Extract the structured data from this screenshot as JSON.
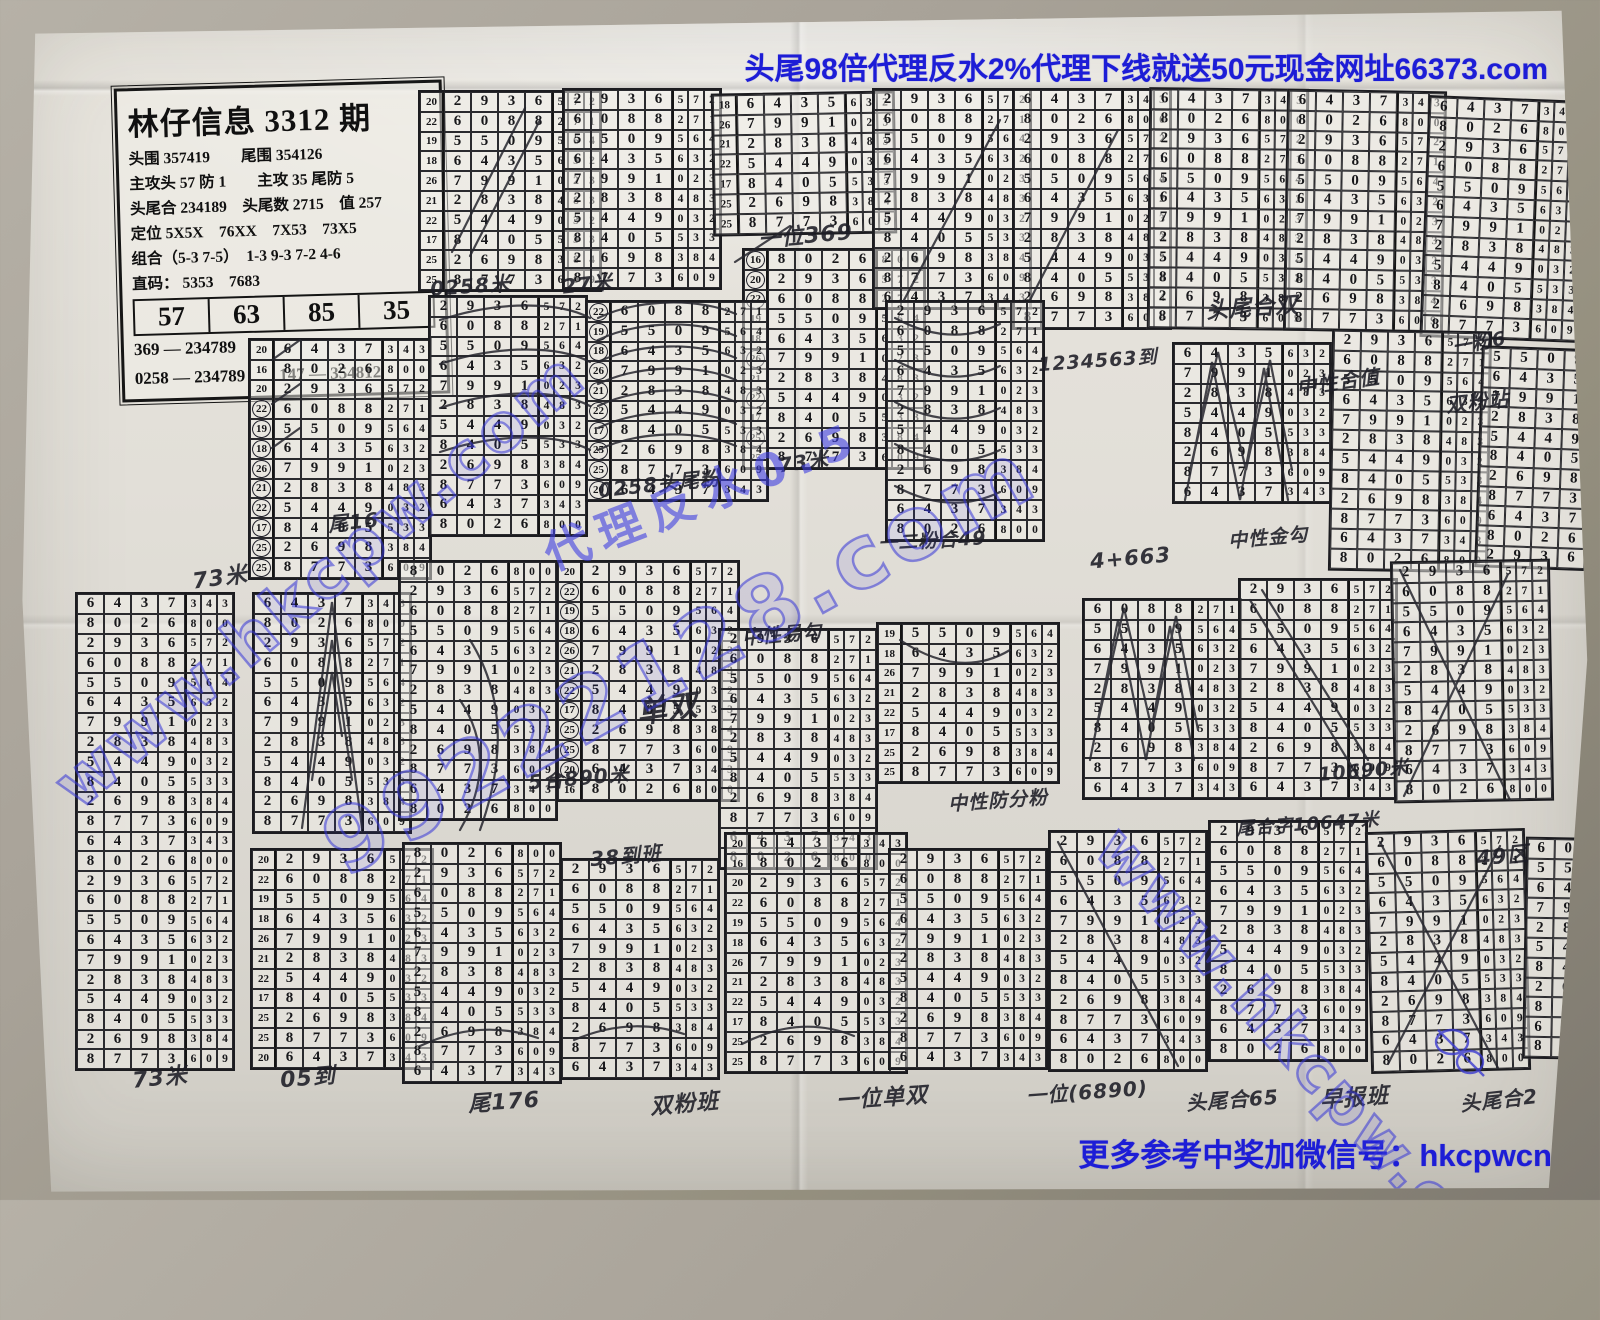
{
  "banners": {
    "top": "头尾98倍代理反水2%代理下线就送50元现金网址66373.com",
    "bottom": "更多参考中奖加微信号：hkcpwcn"
  },
  "info_box": {
    "title": "林仔信息 3312 期",
    "lines": [
      "头围 357419　　尾围 354126",
      "主攻头 57 防 1　　主攻 35 尾防 5",
      "头尾合 234189　头尾数 2715　值 257",
      "定位 5X5X　76XX　7X53　73X5",
      "组合（5-3 7-5）　1-3 9-3 7-2 4-6",
      "直码：  5353　7683"
    ],
    "big_numbers": [
      "57",
      "63",
      "85",
      "35"
    ],
    "footer_lines": [
      "369 — 234789",
      "0258 — 234789　　147 — 354812"
    ]
  },
  "watermarks": {
    "left": "www.hkcpw.com",
    "center": "99222128.com",
    "right": "www.hkcpw.com",
    "diagonal": "代理反水0.5"
  },
  "grid_base": {
    "row_labels": [
      "20",
      "16",
      "20",
      "22",
      "19",
      "18",
      "26",
      "21",
      "22",
      "17",
      "25",
      "25"
    ],
    "rows": [
      "6437343",
      "8026800",
      "2936572",
      "6088271",
      "5509564",
      "6435632",
      "7991023",
      "2838483",
      "5449032",
      "8405533",
      "2698384",
      "8773609"
    ]
  },
  "grids": [
    {
      "x": 418,
      "y": 90,
      "start": 2,
      "count": 10,
      "labels": true,
      "rot": 0
    },
    {
      "x": 562,
      "y": 88,
      "start": 2,
      "count": 10,
      "labels": false,
      "rot": 0
    },
    {
      "x": 712,
      "y": 92,
      "start": 5,
      "count": 7,
      "labels": true,
      "rot": -1
    },
    {
      "x": 742,
      "y": 248,
      "start": 1,
      "count": 11,
      "labels": true,
      "rot": 0,
      "circled": [
        0,
        1,
        2,
        5,
        7,
        9
      ]
    },
    {
      "x": 872,
      "y": 88,
      "start": 2,
      "count": 11,
      "labels": false,
      "rot": 0
    },
    {
      "x": 1012,
      "y": 88,
      "start": 0,
      "count": 12,
      "labels": false,
      "rot": 0
    },
    {
      "x": 1148,
      "y": 88,
      "start": 0,
      "count": 12,
      "labels": false,
      "rot": 0.6
    },
    {
      "x": 1285,
      "y": 90,
      "start": 0,
      "count": 12,
      "labels": false,
      "rot": 1
    },
    {
      "x": 1424,
      "y": 98,
      "start": 0,
      "count": 12,
      "labels": false,
      "rot": 2.2
    },
    {
      "x": 248,
      "y": 338,
      "start": 0,
      "count": 12,
      "labels": true,
      "rot": 0,
      "circled": [
        3,
        4,
        5,
        6,
        7,
        8,
        9,
        10,
        11
      ]
    },
    {
      "x": 428,
      "y": 295,
      "start": 2,
      "count": 12,
      "labels": false,
      "rot": 0
    },
    {
      "x": 585,
      "y": 300,
      "start": 3,
      "count": 10,
      "labels": true,
      "rot": 0,
      "circled": [
        0,
        1,
        2,
        3,
        4,
        5,
        6,
        7,
        8,
        9
      ]
    },
    {
      "x": 885,
      "y": 300,
      "start": 2,
      "count": 12,
      "labels": false,
      "rot": 0
    },
    {
      "x": 1172,
      "y": 342,
      "start": 5,
      "count": 8,
      "labels": false,
      "rot": 0
    },
    {
      "x": 1330,
      "y": 330,
      "start": 2,
      "count": 12,
      "labels": false,
      "rot": 1
    },
    {
      "x": 1478,
      "y": 348,
      "start": 4,
      "count": 11,
      "labels": false,
      "rot": 2
    },
    {
      "x": 75,
      "y": 592,
      "start": 0,
      "count": 24,
      "labels": false,
      "rot": 0
    },
    {
      "x": 252,
      "y": 592,
      "start": 0,
      "count": 12,
      "labels": false,
      "rot": 0
    },
    {
      "x": 398,
      "y": 560,
      "start": 1,
      "count": 13,
      "labels": false,
      "rot": 0
    },
    {
      "x": 556,
      "y": 560,
      "start": 2,
      "count": 12,
      "labels": true,
      "rot": 0,
      "circled": [
        1,
        2,
        3,
        4,
        5,
        6,
        7,
        8,
        9,
        10
      ]
    },
    {
      "x": 718,
      "y": 628,
      "start": 2,
      "count": 12,
      "labels": false,
      "rot": 0
    },
    {
      "x": 876,
      "y": 622,
      "start": 4,
      "count": 8,
      "labels": true,
      "rot": 0
    },
    {
      "x": 1082,
      "y": 598,
      "start": 3,
      "count": 10,
      "labels": false,
      "rot": 0
    },
    {
      "x": 1238,
      "y": 578,
      "start": 2,
      "count": 11,
      "labels": false,
      "rot": 0
    },
    {
      "x": 1392,
      "y": 560,
      "start": 2,
      "count": 12,
      "labels": false,
      "rot": -1
    },
    {
      "x": 250,
      "y": 848,
      "start": 2,
      "count": 11,
      "labels": true,
      "rot": 0
    },
    {
      "x": 402,
      "y": 842,
      "start": 1,
      "count": 12,
      "labels": false,
      "rot": 0
    },
    {
      "x": 560,
      "y": 858,
      "start": 2,
      "count": 11,
      "labels": false,
      "rot": 0
    },
    {
      "x": 724,
      "y": 832,
      "start": 0,
      "count": 12,
      "labels": true,
      "rot": 0
    },
    {
      "x": 888,
      "y": 848,
      "start": 2,
      "count": 11,
      "labels": false,
      "rot": 0
    },
    {
      "x": 1048,
      "y": 830,
      "start": 2,
      "count": 12,
      "labels": false,
      "rot": 0
    },
    {
      "x": 1208,
      "y": 820,
      "start": 2,
      "count": 12,
      "labels": false,
      "rot": 0
    },
    {
      "x": 1368,
      "y": 830,
      "start": 2,
      "count": 12,
      "labels": false,
      "rot": -1.5
    },
    {
      "x": 1524,
      "y": 838,
      "start": 3,
      "count": 11,
      "labels": false,
      "rot": 1
    }
  ],
  "annotations": [
    {
      "t": "0258米",
      "x": 430,
      "y": 270,
      "r": -4,
      "s": 20
    },
    {
      "t": "27米",
      "x": 562,
      "y": 268,
      "r": -6,
      "s": 20
    },
    {
      "t": "一位369",
      "x": 758,
      "y": 218,
      "r": -5,
      "s": 22
    },
    {
      "t": "73米",
      "x": 192,
      "y": 560,
      "r": -8,
      "s": 22
    },
    {
      "t": "尾16",
      "x": 328,
      "y": 506,
      "r": -6,
      "s": 20
    },
    {
      "t": "0258头尾粉",
      "x": 598,
      "y": 468,
      "r": -6,
      "s": 20
    },
    {
      "t": "73米",
      "x": 778,
      "y": 446,
      "r": -8,
      "s": 20
    },
    {
      "t": "头尾合双",
      "x": 1206,
      "y": 290,
      "r": -4,
      "s": 22
    },
    {
      "t": "中性合值",
      "x": 1296,
      "y": 366,
      "r": -8,
      "s": 20
    },
    {
      "t": "一粉6",
      "x": 1452,
      "y": 328,
      "r": -10,
      "s": 19
    },
    {
      "t": "双粉站",
      "x": 1446,
      "y": 386,
      "r": -6,
      "s": 20
    },
    {
      "t": "1234563到",
      "x": 1038,
      "y": 346,
      "r": -4,
      "s": 19
    },
    {
      "t": "4+663",
      "x": 1090,
      "y": 546,
      "r": -5,
      "s": 21
    },
    {
      "t": "一二粉合49",
      "x": 878,
      "y": 526,
      "r": -3,
      "s": 19
    },
    {
      "t": "中性金勾",
      "x": 1228,
      "y": 523,
      "r": -5,
      "s": 19
    },
    {
      "t": "中性易勾",
      "x": 742,
      "y": 620,
      "r": -5,
      "s": 19
    },
    {
      "t": "单双",
      "x": 636,
      "y": 684,
      "r": -8,
      "s": 30
    },
    {
      "t": "5合890米",
      "x": 528,
      "y": 762,
      "r": -5,
      "s": 20
    },
    {
      "t": "38到班",
      "x": 590,
      "y": 840,
      "r": -5,
      "s": 20
    },
    {
      "t": "中性防分粉",
      "x": 948,
      "y": 786,
      "r": -4,
      "s": 19
    },
    {
      "t": "10690米",
      "x": 1318,
      "y": 756,
      "r": -5,
      "s": 19
    },
    {
      "t": "尾合字10647米",
      "x": 1236,
      "y": 810,
      "r": -4,
      "s": 18
    },
    {
      "t": "49区",
      "x": 1476,
      "y": 840,
      "r": -6,
      "s": 21
    },
    {
      "t": "73米",
      "x": 132,
      "y": 1060,
      "r": -6,
      "s": 22
    },
    {
      "t": "05到",
      "x": 280,
      "y": 1060,
      "r": -5,
      "s": 22
    },
    {
      "t": "尾176",
      "x": 468,
      "y": 1084,
      "r": -4,
      "s": 22
    },
    {
      "t": "双粉班",
      "x": 650,
      "y": 1086,
      "r": -5,
      "s": 22
    },
    {
      "t": "一位单双",
      "x": 836,
      "y": 1080,
      "r": -4,
      "s": 22
    },
    {
      "t": "一位(6890)",
      "x": 1026,
      "y": 1076,
      "r": -4,
      "s": 20
    },
    {
      "t": "头尾合65",
      "x": 1186,
      "y": 1084,
      "r": -4,
      "s": 20
    },
    {
      "t": "早报班",
      "x": 1320,
      "y": 1080,
      "r": -4,
      "s": 22
    },
    {
      "t": "头尾合2",
      "x": 1460,
      "y": 1084,
      "r": -6,
      "s": 20
    }
  ]
}
